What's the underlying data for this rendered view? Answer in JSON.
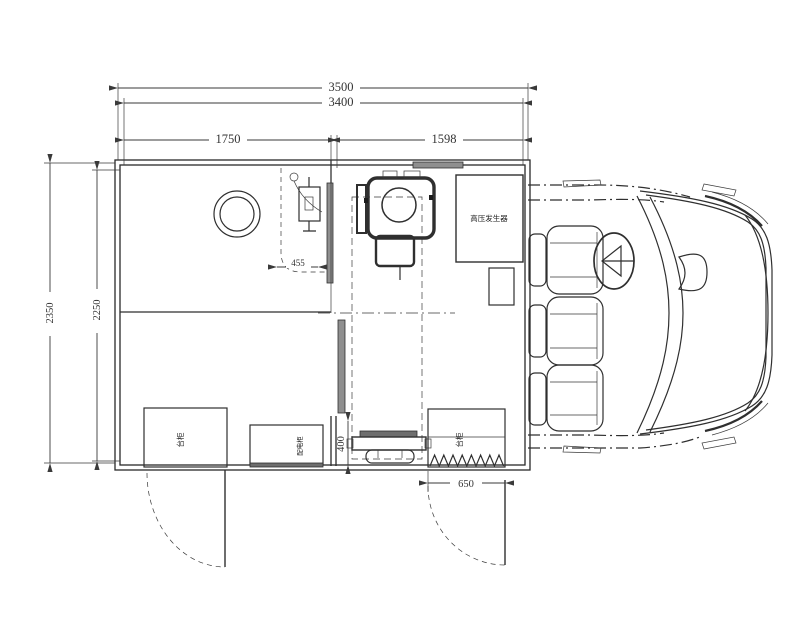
{
  "drawing": {
    "background": "#ffffff",
    "line_color": "#2f2f2f",
    "panel_fill": "#8f8f8f"
  },
  "dimensions": {
    "overall_length": "3500",
    "body_length": "3400",
    "left_room_width": "1750",
    "right_room_width": "1598",
    "overall_width": "2350",
    "interior_width": "2250",
    "console_width": "455",
    "aisle_width": "400",
    "door_width": "650"
  },
  "labels": {
    "hv_generator": "高压发生器",
    "left_cabinet": "台柜",
    "power_cabinet": "配电柜",
    "right_cabinet": "台柜"
  }
}
